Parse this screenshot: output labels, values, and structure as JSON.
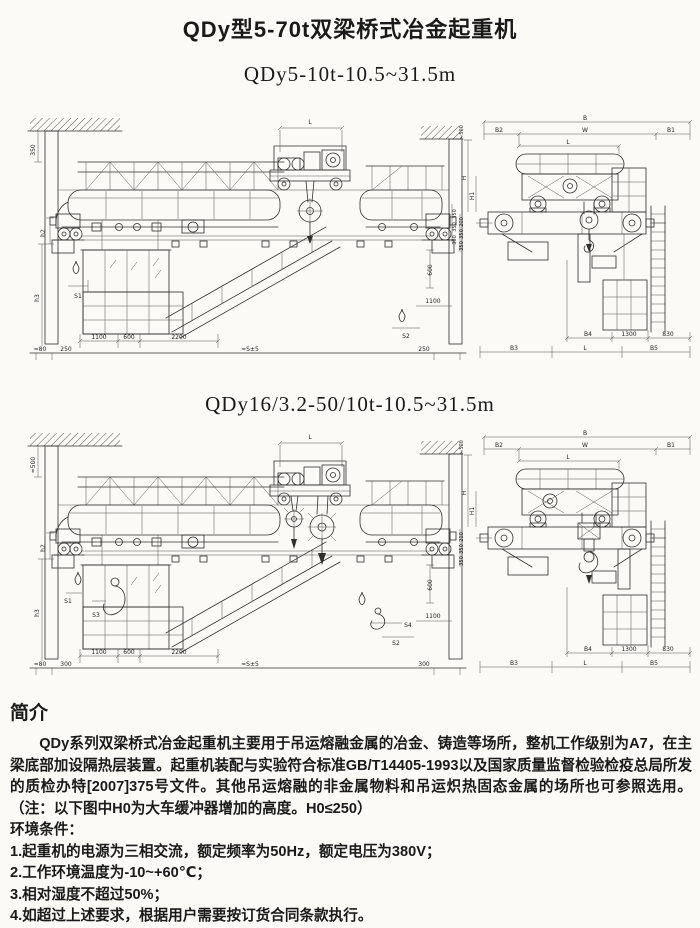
{
  "title": "QDy型5-70t双梁桥式冶金起重机",
  "figures": [
    {
      "subtitle": "QDy5-10t-10.5~31.5m",
      "front": {
        "v_top": "350",
        "h2": "h2",
        "h3": "h3",
        "s1": "S1",
        "s2": "S2",
        "l": "L",
        "d1100": "1100",
        "d600": "600",
        "d2200": "2200",
        "approx80": "≈80",
        "left_end": "250",
        "span": "≈S±5",
        "right_end": "250",
        "rstack": [
          "350",
          "350",
          "300"
        ],
        "r600": "600",
        "r1100": "1100"
      },
      "side": {
        "b": "B",
        "b2": "B2",
        "w": "W",
        "b1": "B1",
        "l_top": "L",
        "h": "H",
        "h1": "H1",
        "v500": "≈500",
        "lstack": [
          "200",
          "350",
          "350"
        ],
        "b4": "B4",
        "d1300": "1300",
        "d830": "830",
        "b3": "B3",
        "l_bot": "L",
        "b5": "B5"
      }
    },
    {
      "subtitle": "QDy16/3.2-50/10t-10.5~31.5m",
      "front": {
        "v_top": "≈500",
        "h2": "h2",
        "h3": "h3",
        "s1": "S1",
        "s3": "S3",
        "s4": "S4",
        "s2": "S2",
        "l": "L",
        "d1100": "1100",
        "d600": "600",
        "d2200": "2200",
        "approx80": "≈80",
        "left_end": "300",
        "span": "≈S±5",
        "right_end": "300",
        "r600": "600",
        "r1100": "1100"
      },
      "side": {
        "b": "B",
        "b2": "B2",
        "w": "W",
        "b1": "B1",
        "l_top": "L",
        "h": "H",
        "h1": "H1",
        "v500": "≈500",
        "lstack": [
          "200",
          "350",
          "350"
        ],
        "b4": "B4",
        "d1300": "1300",
        "d830": "830",
        "b3": "B3",
        "l_bot": "L",
        "b5": "B5"
      }
    }
  ],
  "intro": {
    "heading": "简介",
    "paragraph": "QDy系列双梁桥式冶金起重机主要用于吊运熔融金属的冶金、铸造等场所，整机工作级别为A7，在主梁底部加设隔热层装置。起重机装配与实验符合标准GB/T14405-1993以及国家质量监督检验检疫总局所发的质检办特[2007]375号文件。其他吊运熔融的非金属物料和吊运炽热固态金属的场所也可参照选用。（注：以下图中H0为大车缓冲器增加的高度。H0≤250）",
    "env_label": "环境条件：",
    "conditions": [
      "1.起重机的电源为三相交流，额定频率为50Hz，额定电压为380V；",
      "2.工作环境温度为-10~+60℃；",
      "3.相对湿度不超过50%；",
      "4.如超过上述要求，根据用户需要按订货合同条款执行。"
    ]
  }
}
